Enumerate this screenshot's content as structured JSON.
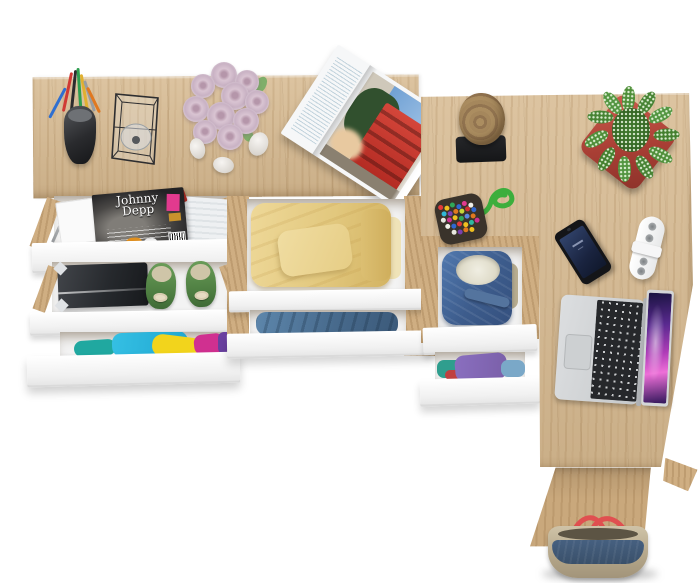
{
  "scene": {
    "type": "top-down product render of an L-shaped oak desk with open white drawers",
    "magazine_cover_title": "Johnny Depp",
    "palette": {
      "background": "#ffffff",
      "oak_wood": "#d5b88f",
      "oak_wood_leg": "#c9a87c",
      "drawer_front_white": "#f4f4f4",
      "rose_pink": "#d9c4d2",
      "plant_green": "#4f8f3a",
      "pot_coral_red": "#b5453a",
      "sweater_yellow": "#e2c87e",
      "clothes_blue": "#51789c",
      "denim_blue": "#44689e",
      "flats_green": "#558c4a",
      "magazine_red_building": "#c23a2e",
      "badge_pink": "#e23a8e",
      "laptop_silver": "#ccced0",
      "laptop_screen_purple": "#a03db8",
      "bag_navy": "#3f5570",
      "bag_khaki": "#c2b59a",
      "bag_strap_red": "#e05050",
      "stool_wood": "#a8895c",
      "stool_base_black": "#1d1e20",
      "cord_green": "#3cae3c"
    },
    "objects": [
      {
        "name": "pencil-cup",
        "desc": "black cup with pens and pencils"
      },
      {
        "name": "wire-basket",
        "desc": "black wireframe holder with glass"
      },
      {
        "name": "rose-bouquet",
        "desc": "pale pink roses"
      },
      {
        "name": "pebbles",
        "desc": "three white stones"
      },
      {
        "name": "open-magazine",
        "desc": "architecture spread with red building"
      },
      {
        "name": "johnny-depp-magazine",
        "desc": "movie magazine in top drawer"
      },
      {
        "name": "storage-box",
        "desc": "dark box in drawer"
      },
      {
        "name": "green-flats",
        "desc": "green shoes with cream bows"
      },
      {
        "name": "folded-yellow-clothes",
        "desc": "folded yellow sweater"
      },
      {
        "name": "folded-blue-clothes",
        "desc": "folded blue shirt"
      },
      {
        "name": "multicolor-clothes",
        "desc": "colorful clothes in bottom drawer"
      },
      {
        "name": "denim-jacket",
        "desc": "blue denim jacket with fleece lining"
      },
      {
        "name": "purple-teal-clothes",
        "desc": "purple and teal clothes"
      },
      {
        "name": "log-stool",
        "desc": "wooden log on black base"
      },
      {
        "name": "pompom-keychain",
        "desc": "multicolour felt balls with green cord"
      },
      {
        "name": "succulent-plant",
        "desc": "green plant in coral square pot"
      },
      {
        "name": "smartphone",
        "desc": "black phone, dark blue screen"
      },
      {
        "name": "cable-organizer",
        "desc": "white clip organizer"
      },
      {
        "name": "laptop",
        "desc": "silver laptop, purple galaxy wallpaper"
      },
      {
        "name": "tote-bag",
        "desc": "navy and khaki bag with red straps"
      }
    ]
  }
}
